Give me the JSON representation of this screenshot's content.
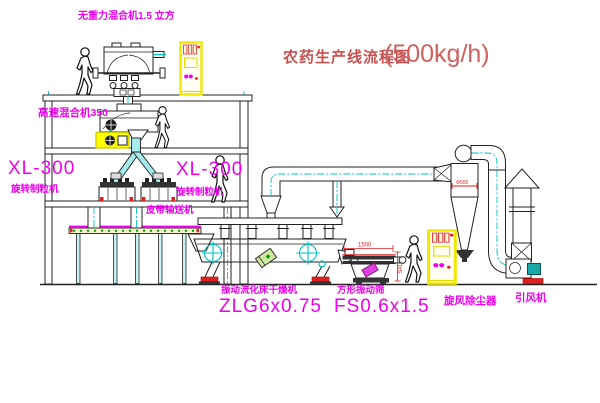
{
  "title": {
    "name": "农药生产线流程图",
    "capacity": "(500kg/h)"
  },
  "equipment": {
    "gravity_mixer": {
      "label": "无重力混合机1.5 立方"
    },
    "high_speed_mixer": {
      "label": "高速混合机350"
    },
    "granulator_left": {
      "model": "XL-300",
      "name": "旋转制粒机"
    },
    "granulator_right": {
      "model": "XL-300",
      "name": "旋转制粒机"
    },
    "belt_conveyor": {
      "label": "皮带输送机"
    },
    "fluid_bed_dryer": {
      "name": "振动流化床干燥机",
      "model": "ZLG6x0.75"
    },
    "vibrating_screen": {
      "name": "方形振动筛",
      "model": "FS0.6x1.5"
    },
    "cyclone": {
      "label": "旋风除尘器"
    },
    "draft_fan": {
      "label": "引风机"
    }
  },
  "dimensions": {
    "screen_length": "1500",
    "screen_height": "541",
    "cyclone_note": "Φ500"
  },
  "colors": {
    "label_magenta": "#ee00ee",
    "title_red": "#c75050",
    "line_cyan": "#00c3c3",
    "cabinet_yellow": "#f0e800",
    "highlight_red": "#e02020"
  }
}
